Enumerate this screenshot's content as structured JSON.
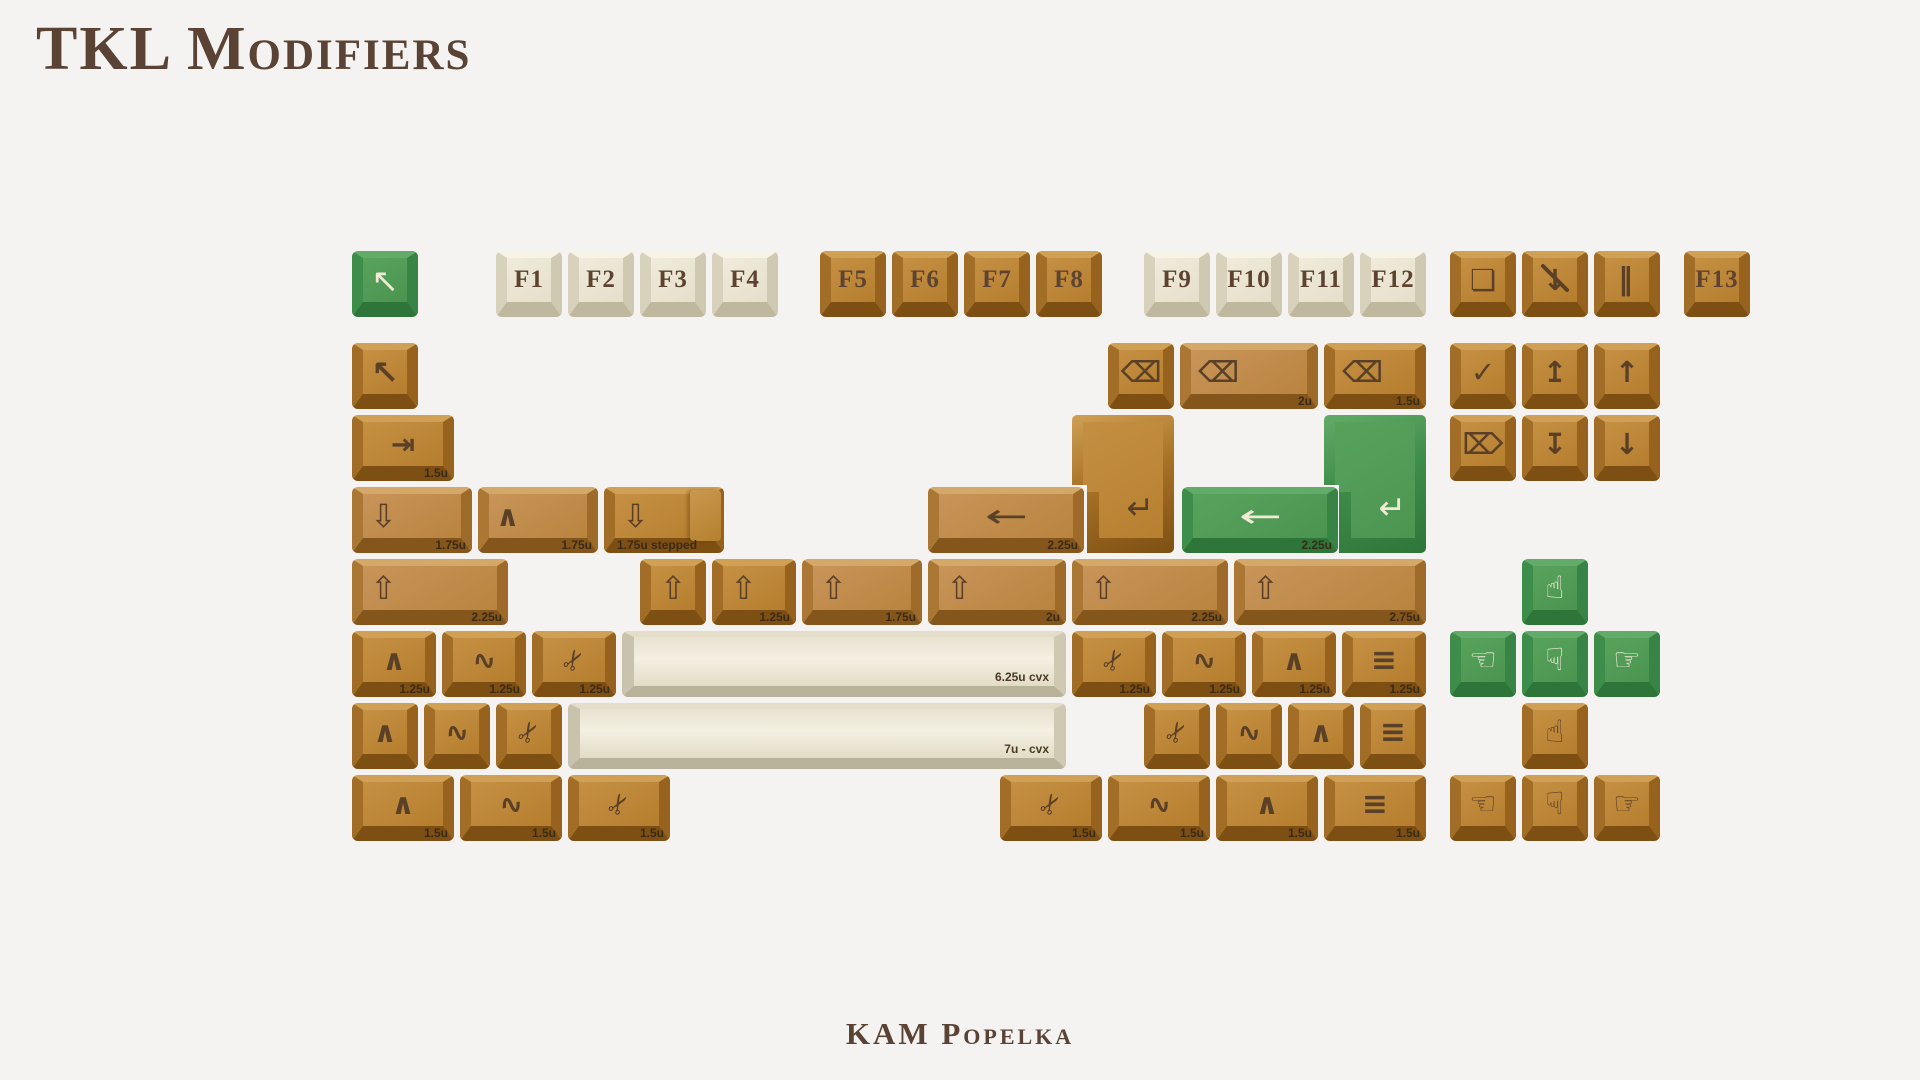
{
  "page": {
    "title": "TKL Modifiers",
    "footer": "KAM Popelka",
    "background_color": "#f4f3f1",
    "text_color": "#5a4334"
  },
  "colors": {
    "brown_key": "#bc8434",
    "brown_light_key": "#c08b4d",
    "cream_key": "#ece7d6",
    "green_key": "#4f9954",
    "legend_brown": "#5b4028",
    "legend_cream": "#f1ead5"
  },
  "icon_glyphs": {
    "arrow-pointer": "↖",
    "backspace": "⌫",
    "tab": "⇥",
    "caps-lock": "⇩",
    "shift": "⇧",
    "control": "∧",
    "super": "∿",
    "alt": "✂",
    "menu": "≡",
    "enter": "↵",
    "enter-left": "←",
    "insert": "✓",
    "home": "↥",
    "page-up": "↑",
    "delete": "⌦",
    "end": "↧",
    "page-down": "↓",
    "print-screen": "❏",
    "scroll-lock": "↓",
    "pause": "‖",
    "hand-up": "☝",
    "hand-down": "☟",
    "hand-left": "☜",
    "hand-right": "☞"
  },
  "keyboard": {
    "keys": [
      {
        "n": "esc-green",
        "i": "arrow-pointer",
        "x": 352,
        "y": 251,
        "s": "green"
      },
      {
        "n": "f1",
        "l": "F1",
        "x": 496,
        "y": 251,
        "s": "cream"
      },
      {
        "n": "f2",
        "l": "F2",
        "x": 568,
        "y": 251,
        "s": "cream"
      },
      {
        "n": "f3",
        "l": "F3",
        "x": 640,
        "y": 251,
        "s": "cream"
      },
      {
        "n": "f4",
        "l": "F4",
        "x": 712,
        "y": 251,
        "s": "cream"
      },
      {
        "n": "f5",
        "l": "F5",
        "x": 820,
        "y": 251,
        "s": "brown"
      },
      {
        "n": "f6",
        "l": "F6",
        "x": 892,
        "y": 251,
        "s": "brown"
      },
      {
        "n": "f7",
        "l": "F7",
        "x": 964,
        "y": 251,
        "s": "brown"
      },
      {
        "n": "f8",
        "l": "F8",
        "x": 1036,
        "y": 251,
        "s": "brown"
      },
      {
        "n": "f9",
        "l": "F9",
        "x": 1144,
        "y": 251,
        "s": "cream"
      },
      {
        "n": "f10",
        "l": "F10",
        "x": 1216,
        "y": 251,
        "s": "cream"
      },
      {
        "n": "f11",
        "l": "F11",
        "x": 1288,
        "y": 251,
        "s": "cream"
      },
      {
        "n": "f12",
        "l": "F12",
        "x": 1360,
        "y": 251,
        "s": "cream"
      },
      {
        "n": "print-screen",
        "i": "print-screen",
        "x": 1450,
        "y": 251,
        "s": "brown"
      },
      {
        "n": "scroll-lock",
        "i": "scroll-lock",
        "x": 1522,
        "y": 251,
        "s": "brown",
        "slash": 1
      },
      {
        "n": "pause",
        "i": "pause",
        "x": 1594,
        "y": 251,
        "s": "brown"
      },
      {
        "n": "f13",
        "l": "F13",
        "x": 1684,
        "y": 251,
        "s": "brown"
      },
      {
        "n": "esc-brown",
        "i": "arrow-pointer",
        "x": 352,
        "y": 343,
        "s": "brown"
      },
      {
        "n": "backspace-1u",
        "i": "backspace",
        "x": 1108,
        "y": 343,
        "s": "brown"
      },
      {
        "n": "backspace-2u",
        "i": "backspace",
        "x": 1180,
        "y": 343,
        "w": 138,
        "s": "brown-light",
        "z": "2u",
        "a": 1
      },
      {
        "n": "backspace-1-5u",
        "i": "backspace",
        "x": 1324,
        "y": 343,
        "w": 102,
        "s": "brown",
        "z": "1.5u",
        "a": 1
      },
      {
        "n": "insert",
        "i": "insert",
        "x": 1450,
        "y": 343,
        "s": "brown"
      },
      {
        "n": "home",
        "i": "home",
        "x": 1522,
        "y": 343,
        "s": "brown"
      },
      {
        "n": "page-up",
        "i": "page-up",
        "x": 1594,
        "y": 343,
        "s": "brown"
      },
      {
        "n": "tab-1-5u",
        "i": "tab",
        "x": 352,
        "y": 415,
        "w": 102,
        "s": "brown",
        "z": "1.5u"
      },
      {
        "n": "iso-enter-brown",
        "i": "enter",
        "x": 1072,
        "y": 415,
        "s": "brown",
        "shape": "iso"
      },
      {
        "n": "iso-enter-green",
        "i": "enter",
        "x": 1324,
        "y": 415,
        "s": "green",
        "shape": "iso"
      },
      {
        "n": "delete",
        "i": "delete",
        "x": 1450,
        "y": 415,
        "s": "brown"
      },
      {
        "n": "end",
        "i": "end",
        "x": 1522,
        "y": 415,
        "s": "brown"
      },
      {
        "n": "page-down",
        "i": "page-down",
        "x": 1594,
        "y": 415,
        "s": "brown"
      },
      {
        "n": "caps-lock-1-75u",
        "i": "caps-lock",
        "x": 352,
        "y": 487,
        "w": 120,
        "s": "brown-light",
        "z": "1.75u",
        "a": 1
      },
      {
        "n": "control-1-75u",
        "i": "control",
        "x": 478,
        "y": 487,
        "w": 120,
        "s": "brown-light",
        "z": "1.75u",
        "a": 1
      },
      {
        "n": "caps-lock-stepped",
        "i": "caps-lock",
        "x": 604,
        "y": 487,
        "w": 120,
        "s": "brown",
        "z": "1.75u stepped",
        "zl": 1,
        "a": 1,
        "shape": "stepped"
      },
      {
        "n": "enter-2-25u-brown",
        "i": "enter-left",
        "x": 928,
        "y": 487,
        "w": 156,
        "s": "brown-light",
        "z": "2.25u"
      },
      {
        "n": "enter-2-25u-green",
        "i": "enter-left",
        "x": 1182,
        "y": 487,
        "w": 156,
        "s": "green",
        "z": "2.25u"
      },
      {
        "n": "shift-2-25u-left",
        "i": "shift",
        "x": 352,
        "y": 559,
        "w": 156,
        "s": "brown-light",
        "z": "2.25u",
        "a": 1
      },
      {
        "n": "shift-1u",
        "i": "shift",
        "x": 640,
        "y": 559,
        "s": "brown"
      },
      {
        "n": "shift-1-25u",
        "i": "shift",
        "x": 712,
        "y": 559,
        "w": 84,
        "s": "brown",
        "z": "1.25u",
        "a": 1
      },
      {
        "n": "shift-1-75u",
        "i": "shift",
        "x": 802,
        "y": 559,
        "w": 120,
        "s": "brown-light",
        "z": "1.75u",
        "a": 1
      },
      {
        "n": "shift-2u",
        "i": "shift",
        "x": 928,
        "y": 559,
        "w": 138,
        "s": "brown-light",
        "z": "2u",
        "a": 1
      },
      {
        "n": "shift-2-25u",
        "i": "shift",
        "x": 1072,
        "y": 559,
        "w": 156,
        "s": "brown-light",
        "z": "2.25u",
        "a": 1
      },
      {
        "n": "shift-2-75u",
        "i": "shift",
        "x": 1234,
        "y": 559,
        "w": 192,
        "s": "brown-light",
        "z": "2.75u",
        "a": 1
      },
      {
        "n": "arrow-up-green",
        "i": "hand-up",
        "x": 1522,
        "y": 559,
        "s": "green"
      },
      {
        "n": "control-1-25u-left",
        "i": "control",
        "x": 352,
        "y": 631,
        "w": 84,
        "s": "brown",
        "z": "1.25u"
      },
      {
        "n": "super-1-25u-left",
        "i": "super",
        "x": 442,
        "y": 631,
        "w": 84,
        "s": "brown",
        "z": "1.25u"
      },
      {
        "n": "alt-1-25u-left",
        "i": "alt",
        "x": 532,
        "y": 631,
        "w": 84,
        "s": "brown",
        "z": "1.25u"
      },
      {
        "n": "spacebar-6-25u",
        "x": 622,
        "y": 631,
        "w": 444,
        "s": "cream",
        "shape": "convex",
        "z": "6.25u cvx"
      },
      {
        "n": "alt-1-25u-right",
        "i": "alt",
        "x": 1072,
        "y": 631,
        "w": 84,
        "s": "brown",
        "z": "1.25u"
      },
      {
        "n": "super-1-25u-right",
        "i": "super",
        "x": 1162,
        "y": 631,
        "w": 84,
        "s": "brown",
        "z": "1.25u"
      },
      {
        "n": "control-1-25u-right",
        "i": "control",
        "x": 1252,
        "y": 631,
        "w": 84,
        "s": "brown",
        "z": "1.25u"
      },
      {
        "n": "menu-1-25u",
        "i": "menu",
        "x": 1342,
        "y": 631,
        "w": 84,
        "s": "brown",
        "z": "1.25u"
      },
      {
        "n": "arrow-left-green",
        "i": "hand-left",
        "x": 1450,
        "y": 631,
        "s": "green"
      },
      {
        "n": "arrow-down-green",
        "i": "hand-down",
        "x": 1522,
        "y": 631,
        "s": "green"
      },
      {
        "n": "arrow-right-green",
        "i": "hand-right",
        "x": 1594,
        "y": 631,
        "s": "green"
      },
      {
        "n": "control-1u-left",
        "i": "control",
        "x": 352,
        "y": 703,
        "s": "brown"
      },
      {
        "n": "super-1u-left",
        "i": "super",
        "x": 424,
        "y": 703,
        "s": "brown"
      },
      {
        "n": "alt-1u-left",
        "i": "alt",
        "x": 496,
        "y": 703,
        "s": "brown"
      },
      {
        "n": "spacebar-7u",
        "x": 568,
        "y": 703,
        "w": 498,
        "s": "cream",
        "shape": "convex",
        "z": "7u - cvx"
      },
      {
        "n": "alt-1u-right",
        "i": "alt",
        "x": 1144,
        "y": 703,
        "s": "brown"
      },
      {
        "n": "super-1u-right",
        "i": "super",
        "x": 1216,
        "y": 703,
        "s": "brown"
      },
      {
        "n": "control-1u-right",
        "i": "control",
        "x": 1288,
        "y": 703,
        "s": "brown"
      },
      {
        "n": "menu-1u",
        "i": "menu",
        "x": 1360,
        "y": 703,
        "s": "brown"
      },
      {
        "n": "arrow-up-brown",
        "i": "hand-up",
        "x": 1522,
        "y": 703,
        "s": "brown"
      },
      {
        "n": "control-1-5u-left",
        "i": "control",
        "x": 352,
        "y": 775,
        "w": 102,
        "s": "brown",
        "z": "1.5u"
      },
      {
        "n": "super-1-5u-left",
        "i": "super",
        "x": 460,
        "y": 775,
        "w": 102,
        "s": "brown",
        "z": "1.5u"
      },
      {
        "n": "alt-1-5u-left",
        "i": "alt",
        "x": 568,
        "y": 775,
        "w": 102,
        "s": "brown",
        "z": "1.5u"
      },
      {
        "n": "alt-1-5u-right",
        "i": "alt",
        "x": 1000,
        "y": 775,
        "w": 102,
        "s": "brown",
        "z": "1.5u"
      },
      {
        "n": "super-1-5u-right",
        "i": "super",
        "x": 1108,
        "y": 775,
        "w": 102,
        "s": "brown",
        "z": "1.5u"
      },
      {
        "n": "control-1-5u-right",
        "i": "control",
        "x": 1216,
        "y": 775,
        "w": 102,
        "s": "brown",
        "z": "1.5u"
      },
      {
        "n": "menu-1-5u",
        "i": "menu",
        "x": 1324,
        "y": 775,
        "w": 102,
        "s": "brown",
        "z": "1.5u"
      },
      {
        "n": "arrow-left-brown",
        "i": "hand-left",
        "x": 1450,
        "y": 775,
        "s": "brown"
      },
      {
        "n": "arrow-down-brown",
        "i": "hand-down",
        "x": 1522,
        "y": 775,
        "s": "brown"
      },
      {
        "n": "arrow-right-brown",
        "i": "hand-right",
        "x": 1594,
        "y": 775,
        "s": "brown"
      }
    ]
  }
}
